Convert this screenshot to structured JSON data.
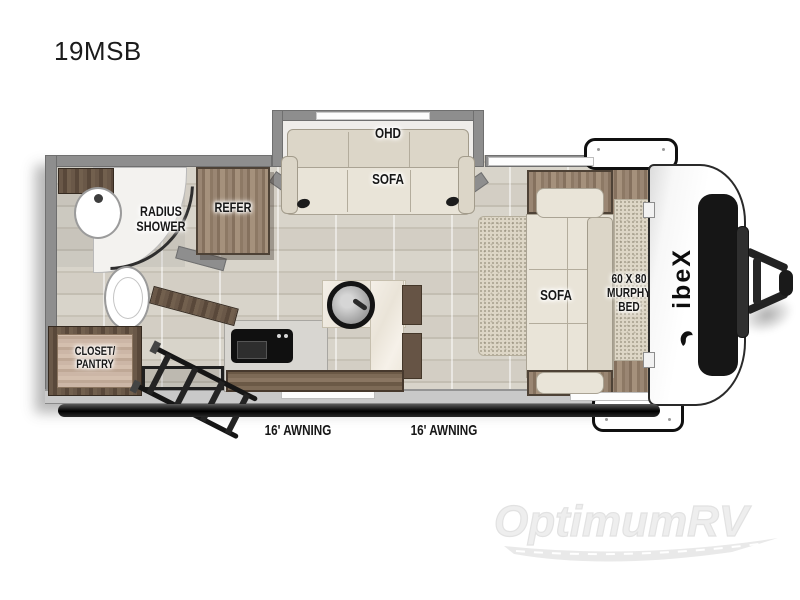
{
  "model": "19MSB",
  "brand": {
    "logo_text": "ibeX",
    "watermark": "OptimumRV"
  },
  "labels": {
    "ohd": "OHD",
    "slide_sofa": "SOFA",
    "radius_shower": [
      "RADIUS",
      "SHOWER"
    ],
    "refer": "REFER",
    "closet_pantry": [
      "CLOSET/",
      "PANTRY"
    ],
    "main_sofa": "SOFA",
    "murphy_bed": [
      "60 X 80",
      "MURPHY",
      "BED"
    ],
    "awning_left": "16' AWNING",
    "awning_right": "16' AWNING"
  },
  "colors": {
    "wall_gray": "#8e8e8e",
    "wall_light": "#c9c9c9",
    "floor": "#d5d1c7",
    "wood": "#8a7562",
    "wood_dark": "#5f4e3f",
    "cream_upholstery": "#e9e4d8",
    "marble_counter": "#f1ece3",
    "black_accent": "#1a1a1a",
    "watermark_gray": "#ececec"
  }
}
